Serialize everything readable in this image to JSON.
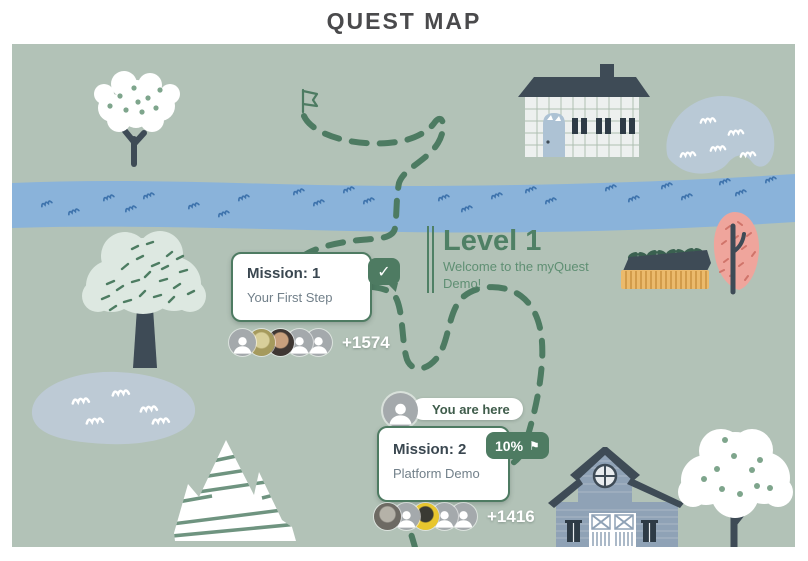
{
  "page_title": "QUEST MAP",
  "level": {
    "heading": "Level 1",
    "subtitle": "Welcome to the myQuest Demo!"
  },
  "you_are_here_label": "You are here",
  "missions": [
    {
      "title": "Mission: 1",
      "subtitle": "Your First Step",
      "status": "completed",
      "check_icon": "✓",
      "participants_more": "+1574",
      "avatars": [
        {
          "type": "silhouette"
        },
        {
          "type": "photo",
          "color": "#a59a5d",
          "accent": "#d8cf9a"
        },
        {
          "type": "photo",
          "color": "#3f3733",
          "accent": "#c8a07d"
        },
        {
          "type": "silhouette"
        },
        {
          "type": "silhouette"
        }
      ]
    },
    {
      "title": "Mission: 2",
      "subtitle": "Platform Demo",
      "progress_label": "10%",
      "flag_icon": "⚑",
      "participants_more": "+1416",
      "avatars": [
        {
          "type": "photo",
          "color": "#6d6a63",
          "accent": "#b5b2a8"
        },
        {
          "type": "silhouette"
        },
        {
          "type": "photo",
          "color": "#e8c62e",
          "accent": "#3a3a33"
        },
        {
          "type": "silhouette"
        },
        {
          "type": "silhouette"
        }
      ]
    }
  ],
  "colors": {
    "accent_green": "#4e7b62",
    "map_background": "#b2c2b7",
    "river_blue": "#8ab3da",
    "title_gray": "#4a4a4c"
  }
}
